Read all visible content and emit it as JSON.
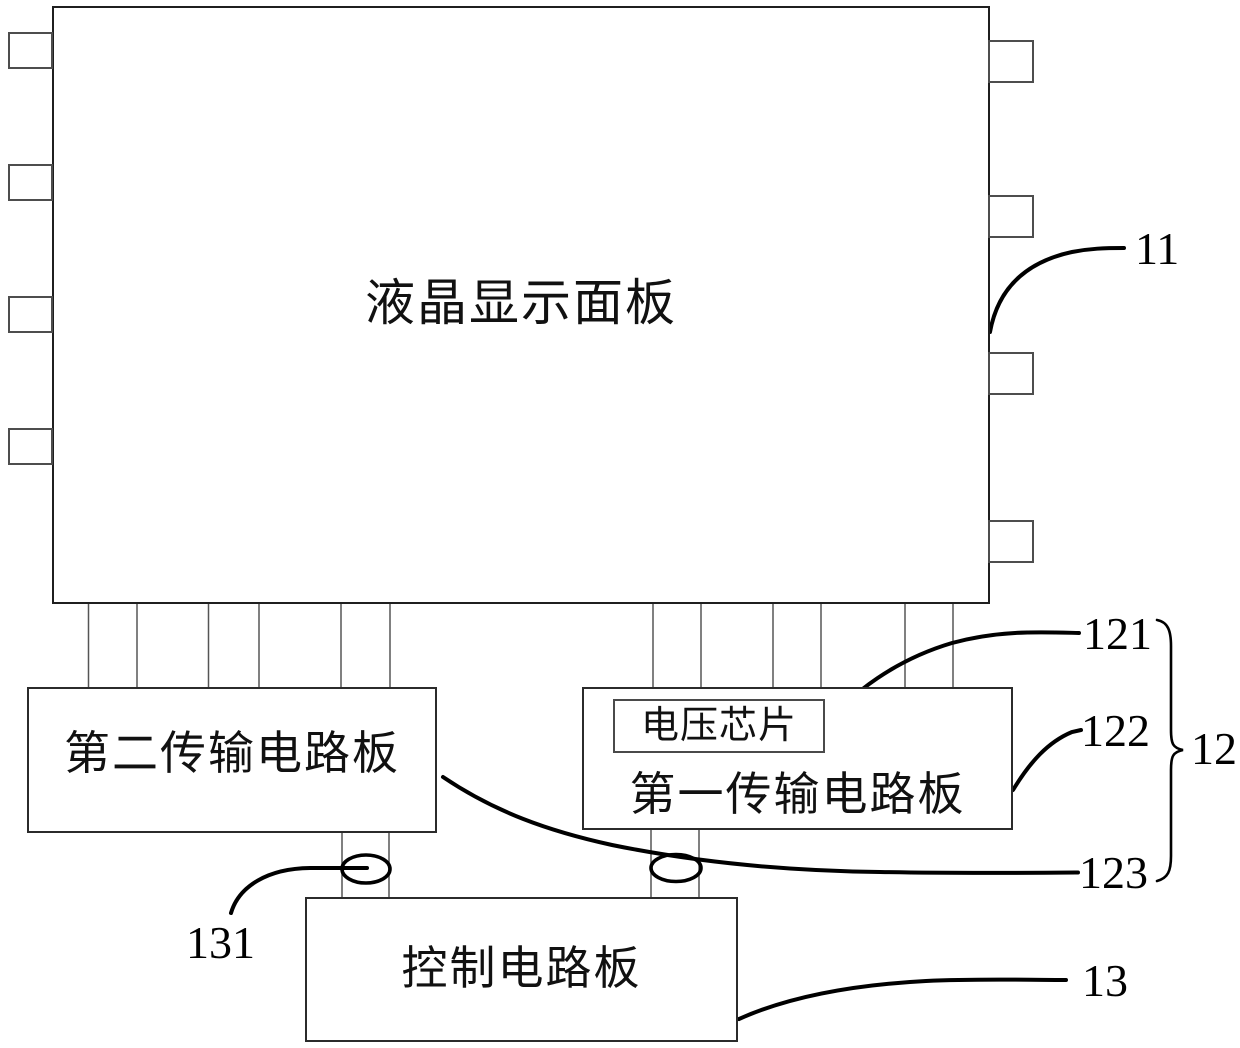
{
  "figure": {
    "panel": {
      "label": "液晶显示面板",
      "ref": "11"
    },
    "voltage_chip": {
      "label": "电压芯片",
      "ref": "121"
    },
    "first_board": {
      "label": "第一传输电路板",
      "ref": "122"
    },
    "transmission_group": {
      "ref": "12"
    },
    "second_board": {
      "label": "第二传输电路板",
      "ref": "123"
    },
    "control_connector": {
      "ref": "131"
    },
    "control_board": {
      "label": "控制电路板",
      "ref": "13"
    },
    "line_color": "#000000",
    "leg_color": "#555555"
  }
}
